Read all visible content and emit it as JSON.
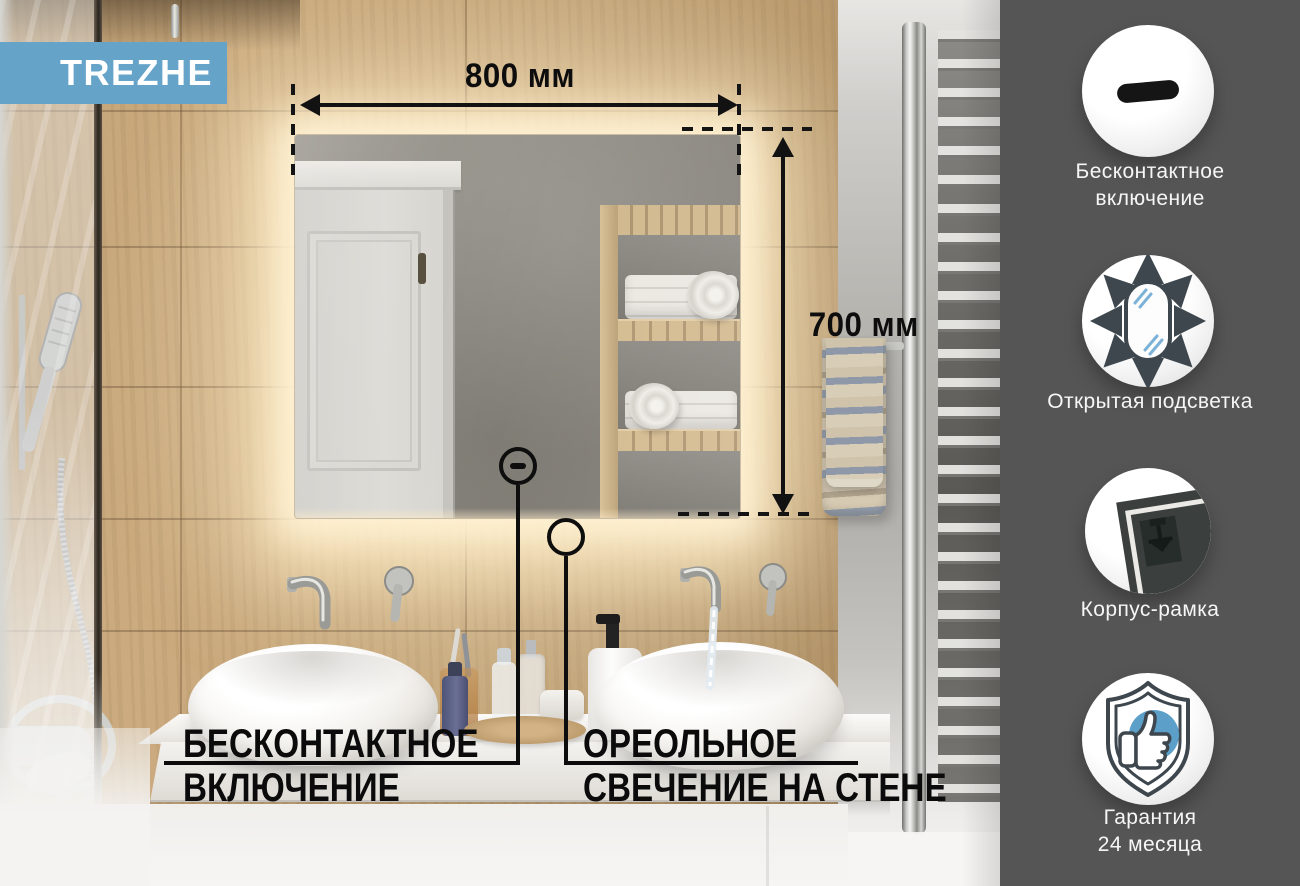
{
  "brand": {
    "label": "TREZHE"
  },
  "photo": {
    "annotations": {
      "width_label": "800 мм",
      "height_label": "700 мм"
    },
    "callouts": {
      "left": {
        "line1": "БЕСКОНТАКТНОЕ",
        "line2": "ВКЛЮЧЕНИЕ"
      },
      "right": {
        "line1": "ОРЕОЛЬНОЕ",
        "line2": "СВЕЧЕНИЕ НА СТЕНЕ"
      }
    }
  },
  "sidebar": {
    "features": [
      {
        "icon": "touch-sensor-icon",
        "label_lines": [
          "Бесконтактное",
          "включение"
        ]
      },
      {
        "icon": "open-backlight-icon",
        "label_lines": [
          "Открытая подсветка"
        ]
      },
      {
        "icon": "frame-body-icon",
        "label_lines": [
          "Корпус-рамка"
        ]
      },
      {
        "icon": "warranty-shield-icon",
        "label_lines": [
          "Гарантия",
          "24 месяца"
        ]
      }
    ]
  },
  "colors": {
    "accent_blue": "#66A3C9",
    "icon_blue": "#5C9FC9",
    "sidebar_bg": "#555555",
    "annotation_black": "#121212"
  }
}
